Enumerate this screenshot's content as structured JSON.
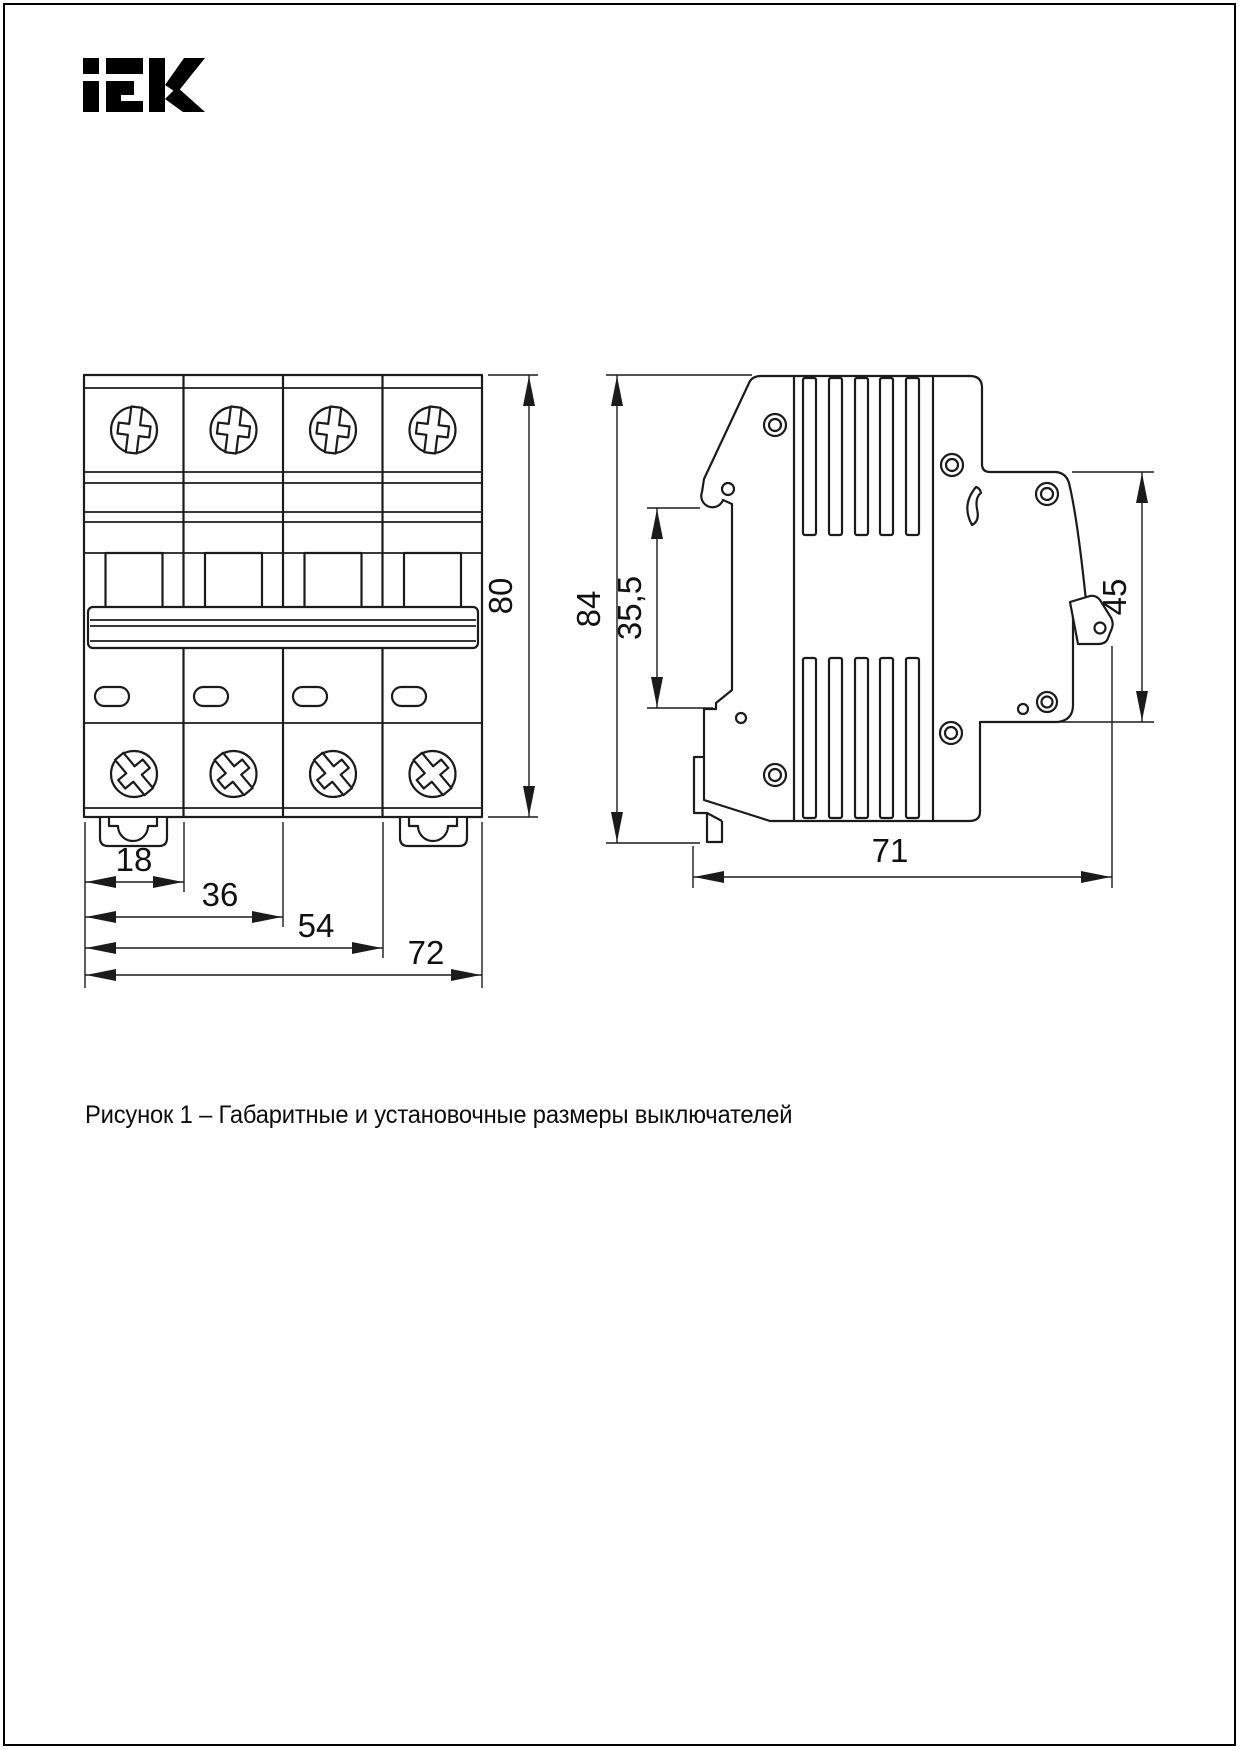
{
  "page": {
    "brand": "IEK",
    "caption": "Рисунок 1 – Габаритные и установочные размеры выключателей"
  },
  "figure": {
    "front_view": {
      "label": "front-view-4-pole-breaker",
      "dimensions": {
        "height": "80",
        "pole_width": "18",
        "two_poles_width": "36",
        "three_poles_width": "54",
        "total_width": "72"
      }
    },
    "side_view": {
      "label": "side-view-breaker-profile",
      "dimensions": {
        "height": "84",
        "din_notch_offset": "35,5",
        "back_height": "45",
        "depth": "71"
      }
    }
  }
}
